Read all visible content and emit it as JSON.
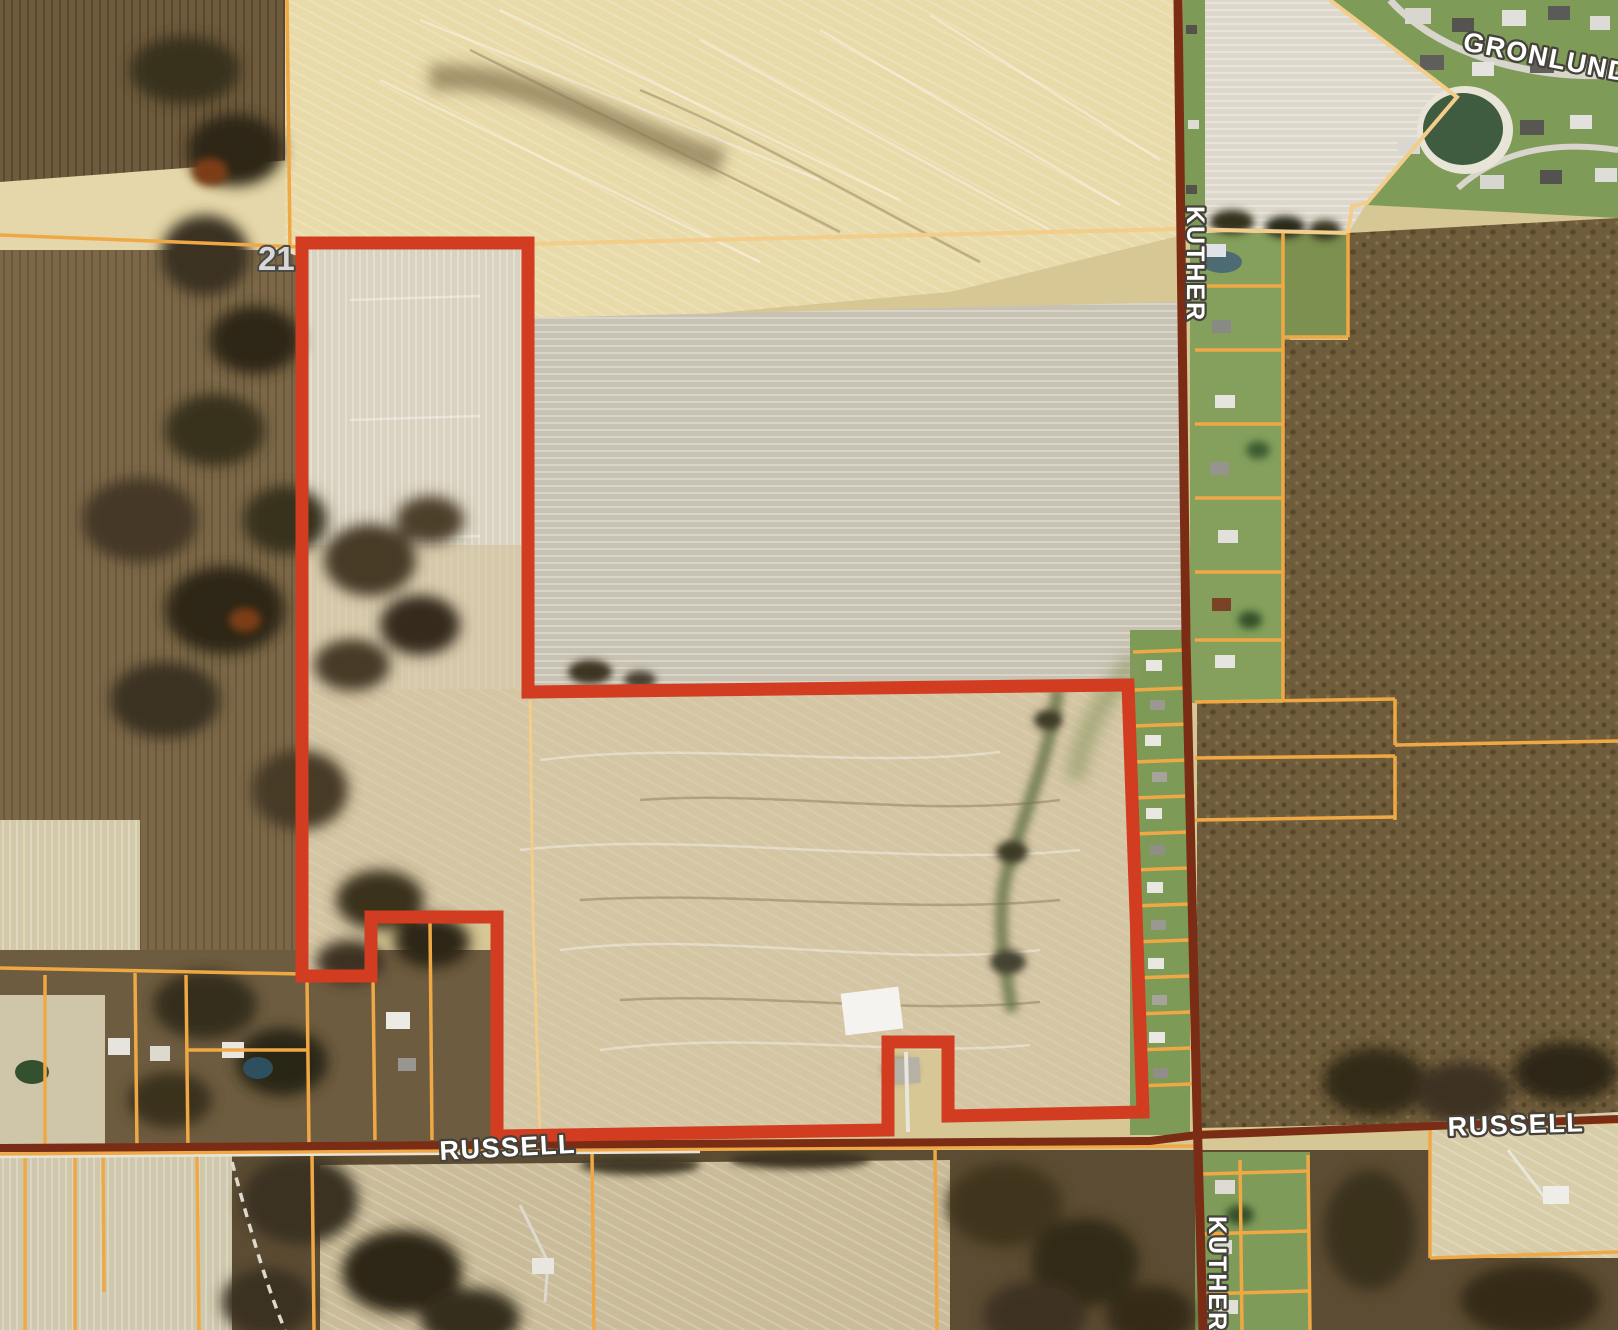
{
  "map": {
    "labels": {
      "gronlund": "GRONLUND",
      "kuther_north": "KUTHER",
      "kuther_south": "KUTHER",
      "russell_west": "RUSSELL",
      "russell_east": "RUSSELL",
      "section_number": "21"
    },
    "colors": {
      "subject_boundary_red": "#d23c20",
      "parcel_line_orange": "#f0a845",
      "section_line_yellow": "#f3cd8a",
      "road_maroon": "#7b2c15",
      "label_text": "#ffffff",
      "label_halo": "#45423a",
      "section_number_fill": "#d8d8d8"
    }
  }
}
